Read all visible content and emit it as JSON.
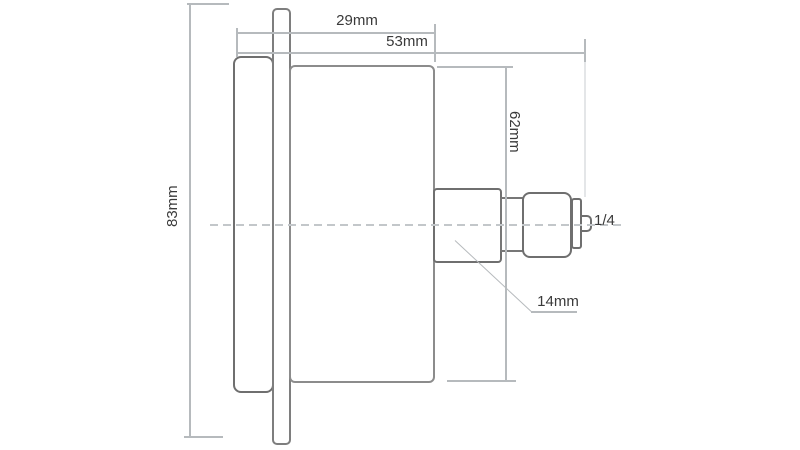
{
  "diagram": {
    "title": "gauge-side-view-dimension-drawing",
    "background_color": "#ffffff",
    "outline_color_heavy": "#666666",
    "outline_color_light": "#8c8c8c",
    "dimension_line_color": "#b6babd",
    "text_color": "#3a3a3a",
    "parts": [
      "front-bezel",
      "mounting-flange",
      "case-body",
      "connection-boss",
      "neck",
      "hex-nut",
      "collar",
      "thread-stub"
    ],
    "dimensions": {
      "flange_height": {
        "label": "83mm",
        "orientation": "vertical"
      },
      "front_depth": {
        "label": "29mm",
        "orientation": "horizontal"
      },
      "total_depth": {
        "label": "53mm",
        "orientation": "horizontal"
      },
      "case_diameter": {
        "label": "62mm",
        "orientation": "vertical"
      },
      "stem": {
        "label": "14mm",
        "orientation": "leader"
      },
      "thread_size": {
        "label": "1/4",
        "orientation": "horizontal"
      }
    }
  }
}
